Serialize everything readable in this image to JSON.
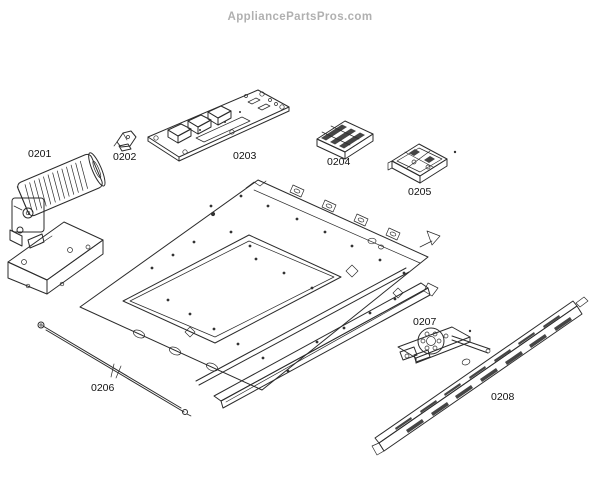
{
  "watermark": "AppliancePartsPros.com",
  "colors": {
    "background": "#ffffff",
    "line_art": "#2b2b2b",
    "label_text": "#111111",
    "watermark_text": "#b0b0b0"
  },
  "diagram": {
    "type": "exploded-parts-diagram",
    "parts": [
      {
        "id": "0201",
        "shape": "convection-blower-motor-with-mounting-bracket"
      },
      {
        "id": "0202",
        "shape": "small-mounting-clip"
      },
      {
        "id": "0203",
        "shape": "power-control-board"
      },
      {
        "id": "0204",
        "shape": "terminal-block"
      },
      {
        "id": "0205",
        "shape": "relay-switch-module"
      },
      {
        "id": "0206",
        "shape": "long-probe-rod"
      },
      {
        "id": "0207",
        "shape": "door-lock-motor-assembly"
      },
      {
        "id": "0208",
        "shape": "vent-grille-trim-strip"
      }
    ],
    "main_component": {
      "shape": "oven-top-panel-assembly",
      "label": ""
    }
  }
}
